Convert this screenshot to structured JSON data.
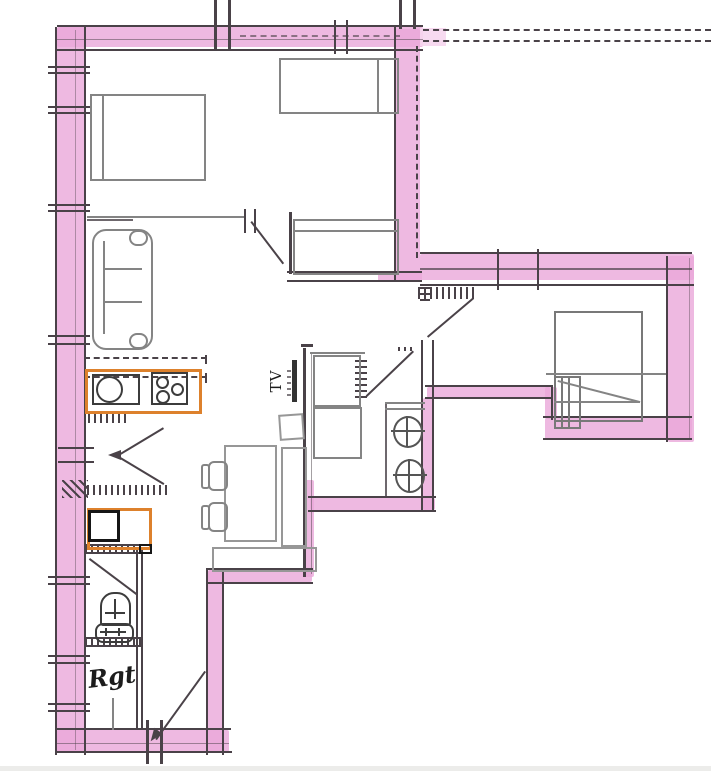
{
  "labels": {
    "tv": "TV",
    "storage": "Rgt"
  },
  "colors": {
    "paper": "#ffffff",
    "wall_highlight": "#eaa8da",
    "wall_highlight_soft": "#f6d6ee",
    "ink": "#4a4248",
    "furniture": "#848484",
    "appliance_orange": "#dd812c",
    "appliance_black": "#161616"
  }
}
